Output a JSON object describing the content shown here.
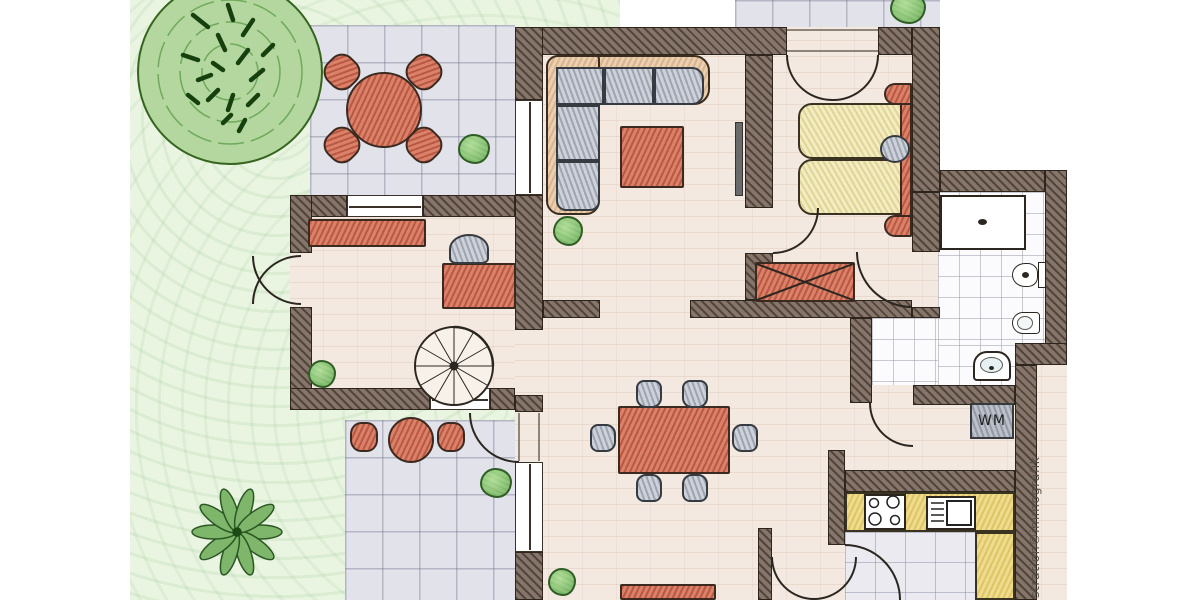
{
  "illustration": {
    "type": "hand-drawn floor plan sketch"
  },
  "watermark": {
    "text": "stration©immografik"
  },
  "labels": {
    "washing_machine": "WM"
  },
  "palette": {
    "wall": "#86756a",
    "wall_outline": "#2e251c",
    "interior_floor": "#f4e9e0",
    "terrace_tile": "#e2e2ea",
    "bathroom_tile": "#fbfbfd",
    "kitchen_tile": "#eaeaf0",
    "furniture_red": "#da8169",
    "furniture_gray": "#cdd1d9",
    "bed_yellow": "#f3ecc0",
    "counter_yellow": "#eedc8e",
    "sofa_tan": "#eacfb0",
    "garden_green": "#e9f4e1",
    "tree_green": "#b3d79e",
    "bush_green": "#8cc878"
  },
  "rooms": [
    {
      "name": "living-room",
      "furniture": [
        "corner-sofa",
        "coffee-table",
        "plant"
      ]
    },
    {
      "name": "bedroom",
      "furniture": [
        "double-bed",
        "headboard",
        "pillow",
        "wardrobe"
      ]
    },
    {
      "name": "bathroom",
      "furniture": [
        "shower",
        "toilet",
        "bidet",
        "washbasin"
      ]
    },
    {
      "name": "utility-nook",
      "furniture": [
        "washing-machine"
      ]
    },
    {
      "name": "kitchen",
      "furniture": [
        "stove",
        "sink",
        "l-counter"
      ]
    },
    {
      "name": "dining-room",
      "furniture": [
        "dining-table",
        "six-chairs",
        "sideboard"
      ]
    },
    {
      "name": "office",
      "furniture": [
        "sideboard",
        "desk",
        "chair",
        "spiral-staircase",
        "plant"
      ]
    }
  ],
  "garden": {
    "elements": [
      "large-tree",
      "fern-plant",
      "bushes",
      "lawn"
    ]
  },
  "terraces": {
    "top": {
      "furniture": [
        "round-table",
        "four-chairs",
        "bush"
      ]
    },
    "bottom": {
      "furniture": [
        "round-table",
        "two-chairs",
        "bush"
      ]
    },
    "walkway": {
      "elements": [
        "bush"
      ]
    }
  }
}
